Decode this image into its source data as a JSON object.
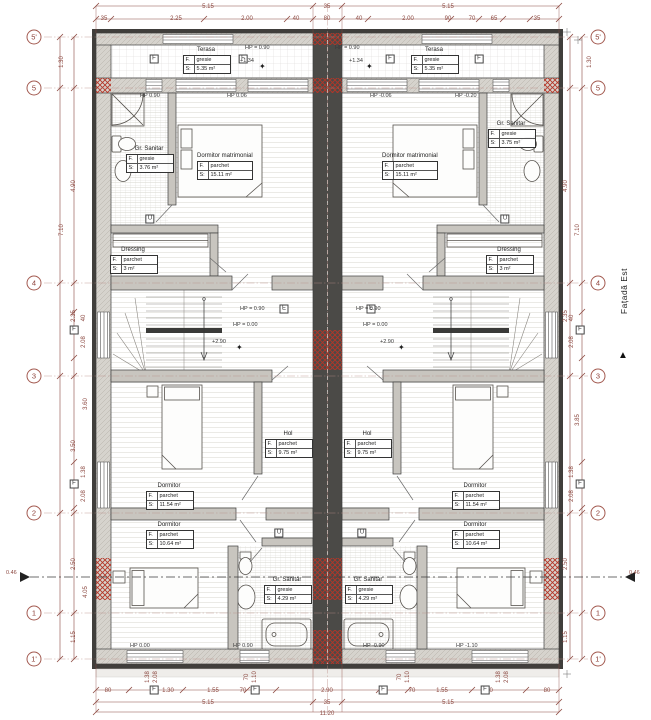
{
  "colors": {
    "dim_line": "#8d4a42",
    "wall_fill": "#d6d3cd",
    "dark_band": "#403e3b",
    "red_hatch": "#b43527",
    "center_wall": "#4b4a47"
  },
  "facade": {
    "label": "Fațadă Est",
    "arrow": "▲"
  },
  "grid": {
    "rows": [
      "5'",
      "5",
      "4",
      "3",
      "2",
      "1",
      "1'"
    ]
  },
  "room_box_labels": {
    "f": "F.",
    "s": "S:"
  },
  "units": {
    "left": {
      "rooms": [
        {
          "name": "Terasa",
          "finish": "gresie",
          "area": "5.35 m²"
        },
        {
          "name": "Gr. Sanitar",
          "finish": "gresie",
          "area": "3.76 m²"
        },
        {
          "name": "Dormitor matrimonial",
          "finish": "parchet",
          "area": "15.11 m²"
        },
        {
          "name": "Dressing",
          "finish": "parchet",
          "area": "3 m²"
        },
        {
          "name": "Hol",
          "finish": "parchet",
          "area": "9.75 m²"
        },
        {
          "name": "Dormitor",
          "finish": "parchet",
          "area": "11.54 m²"
        },
        {
          "name": "Dormitor",
          "finish": "parchet",
          "area": "10.64 m²"
        },
        {
          "name": "Gr. Sanitar",
          "finish": "gresie",
          "area": "4.29 m²"
        }
      ]
    },
    "right": {
      "rooms": [
        {
          "name": "Terasa",
          "finish": "gresie",
          "area": "5.35 m²"
        },
        {
          "name": "Gr. Sanitar",
          "finish": "gresie",
          "area": "3.75 m²"
        },
        {
          "name": "Dormitor matrimonial",
          "finish": "parchet",
          "area": "15.11 m²"
        },
        {
          "name": "Dressing",
          "finish": "parchet",
          "area": "3 m²"
        },
        {
          "name": "Hol",
          "finish": "parchet",
          "area": "9.75 m²"
        },
        {
          "name": "Dormitor",
          "finish": "parchet",
          "area": "11.54 m²"
        },
        {
          "name": "Dormitor",
          "finish": "parchet",
          "area": "10.64 m²"
        },
        {
          "name": "Gr. Sanitar",
          "finish": "gresie",
          "area": "4.29 m²"
        }
      ]
    }
  },
  "levels": {
    "terasa_left": "HP = 0.90",
    "terasa_right": "HP = 0.90",
    "plus_terasa_left": "+1.34",
    "plus_terasa_right": "+1.34",
    "gs_top_left": "HP 0.90",
    "dorm_left": "HP 0.06",
    "dorm_right": "HP -0.06",
    "gs_top_right": "HP -0.20",
    "stair_left_up": "HP = 0.90",
    "stair_left_down": "HP = 0.00",
    "stair_right_up": "HP = 0.90",
    "stair_right_down": "HP = 0.00",
    "plus_stair_left": "+2.90",
    "plus_stair_right": "+2.90",
    "bottom_left": "HP 0.00",
    "bottom_center_left": "HP 0.90",
    "bottom_center_right": "HP -0.90",
    "bottom_right": "HP -1.10",
    "section_left": "0.46",
    "section_right": "0.46",
    "star": "✦"
  },
  "tags": {
    "window_tags": [
      "F",
      "F",
      "F",
      "F",
      "F",
      "F",
      "F",
      "F",
      "F",
      "F",
      "F",
      "F"
    ],
    "door_tags": [
      "U",
      "U",
      "U",
      "U"
    ],
    "e_tags": [
      "E",
      "E"
    ]
  },
  "dims": {
    "top_row1": [
      "5.15",
      "35",
      "5.15"
    ],
    "top_row2": [
      "35",
      "2.25",
      "2.00",
      "40",
      "80",
      "40",
      "2.00",
      "90",
      "70",
      "65",
      "35"
    ],
    "bottom_row1": [
      "80",
      "1.30",
      "1.55",
      "70",
      "2.90",
      "70",
      "1.55",
      "1.30",
      "80"
    ],
    "bottom_row2": [
      "5.15",
      "35",
      "5.15"
    ],
    "bottom_total": [
      "11.20"
    ],
    "left_col": [
      "1.30",
      "4.90",
      "7.10",
      "2.35",
      "3.60",
      "3.50",
      "2.50",
      "4.05",
      "1.15"
    ],
    "right_col": [
      "1.30",
      "4.90",
      "7.10",
      "2.35",
      "3.85",
      "2.50",
      "1.15"
    ],
    "bottom_windows": [
      "1.38",
      "2.08",
      "70",
      "1.10",
      "70",
      "1.10",
      "1.38",
      "2.08"
    ],
    "side_windows": [
      "40",
      "2.08",
      "1.38",
      "2.08",
      "40",
      "2.08",
      "1.38",
      "2.08"
    ]
  }
}
